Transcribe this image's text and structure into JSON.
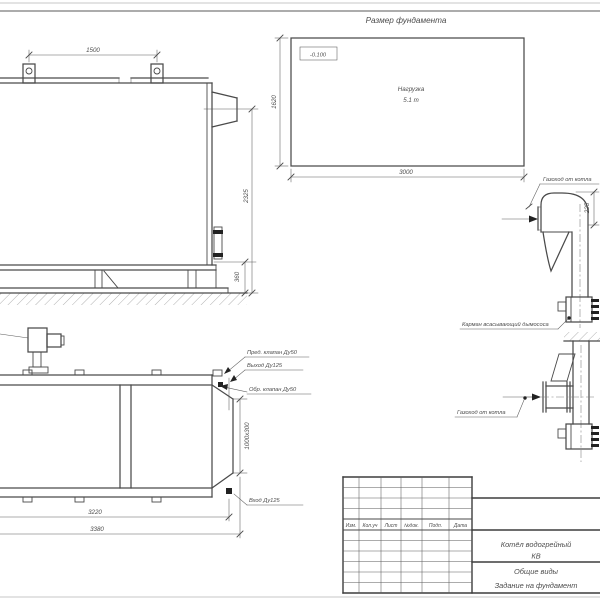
{
  "sheet": {
    "views": {
      "side_view": {
        "dims": {
          "lug_spacing": "1500",
          "height_total": "2325",
          "base_height": "360"
        }
      },
      "foundation_plan": {
        "title": "Размер фундамента",
        "elevation": "-0.100",
        "load_line1": "Нагрузка",
        "load_line2": "5.1 т",
        "dims": {
          "length": "3000",
          "width": "1620"
        }
      },
      "flue_upper": {
        "label_duct": "Газоход от котла",
        "label_pocket": "Карман всасывающий дымососа",
        "dims": {
          "offset": "225"
        }
      },
      "plan_view": {
        "labels": {
          "safety_valve": "Пред. клапан Ду50",
          "outlet": "Выход Ду125",
          "check_valve": "Обр. клапан Ду50",
          "inlet": "Вход Ду125"
        },
        "dims": {
          "length_inner": "3220",
          "length_total": "3380",
          "rear_opening": "1000х300"
        }
      },
      "flue_lower": {
        "label_duct": "Газоход от котла"
      }
    },
    "title_block": {
      "cols": {
        "c1": "Изм.",
        "c2": "Кол.уч",
        "c3": "Лист",
        "c4": "№док.",
        "c5": "Подп.",
        "c6": "Дата"
      },
      "product_line1": "Котёл водогрейный",
      "product_line2": "КВ",
      "doc_line1": "Общие виды",
      "doc_line2": "Задание на фундамент"
    }
  }
}
